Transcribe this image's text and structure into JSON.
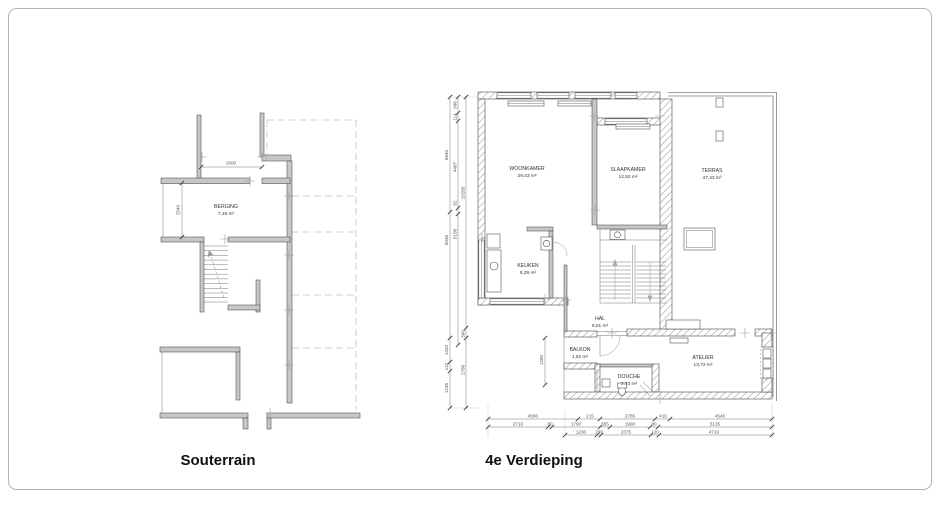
{
  "drawing": {
    "souterrain": {
      "title": "Souterrain",
      "rooms": [
        {
          "name": "BERGING",
          "area": "7,16 m²"
        }
      ],
      "dims": {
        "width": "2600",
        "height": "2540"
      }
    },
    "verdieping": {
      "title": "4e Verdieping",
      "rooms": [
        {
          "name": "WOONKAMER",
          "area": "29,43 m²"
        },
        {
          "name": "SLAAPKAMER",
          "area": "12,52 m²"
        },
        {
          "name": "TERRAS",
          "area": "47,43 m²"
        },
        {
          "name": "KEUKEN",
          "area": "8,29 m²"
        },
        {
          "name": "HAL",
          "area": "9,01 m²"
        },
        {
          "name": "BALKON",
          "area": "1,62 m²"
        },
        {
          "name": "DOUCHE",
          "area": "2,73 m²"
        },
        {
          "name": "ATELIER",
          "area": "13,72 m²"
        }
      ],
      "dims_left_outer": [
        "5640",
        "5035",
        "1420",
        "122",
        "1245"
      ],
      "dims_left_middle": [
        "996",
        "114",
        "4487",
        "82",
        "5108"
      ],
      "dims_left_inner": [
        "10285",
        "390",
        "2786"
      ],
      "dims_bottom_row1": [
        "4580",
        "215",
        "2785",
        "410",
        "4546"
      ],
      "dims_bottom_row2": [
        "2710",
        "80",
        "1790",
        "355",
        "1990",
        "80",
        "5135"
      ],
      "dims_bottom_row3": [
        "1230",
        "290",
        "2375",
        "120",
        "4710"
      ],
      "dim_balkon": "1280"
    }
  }
}
